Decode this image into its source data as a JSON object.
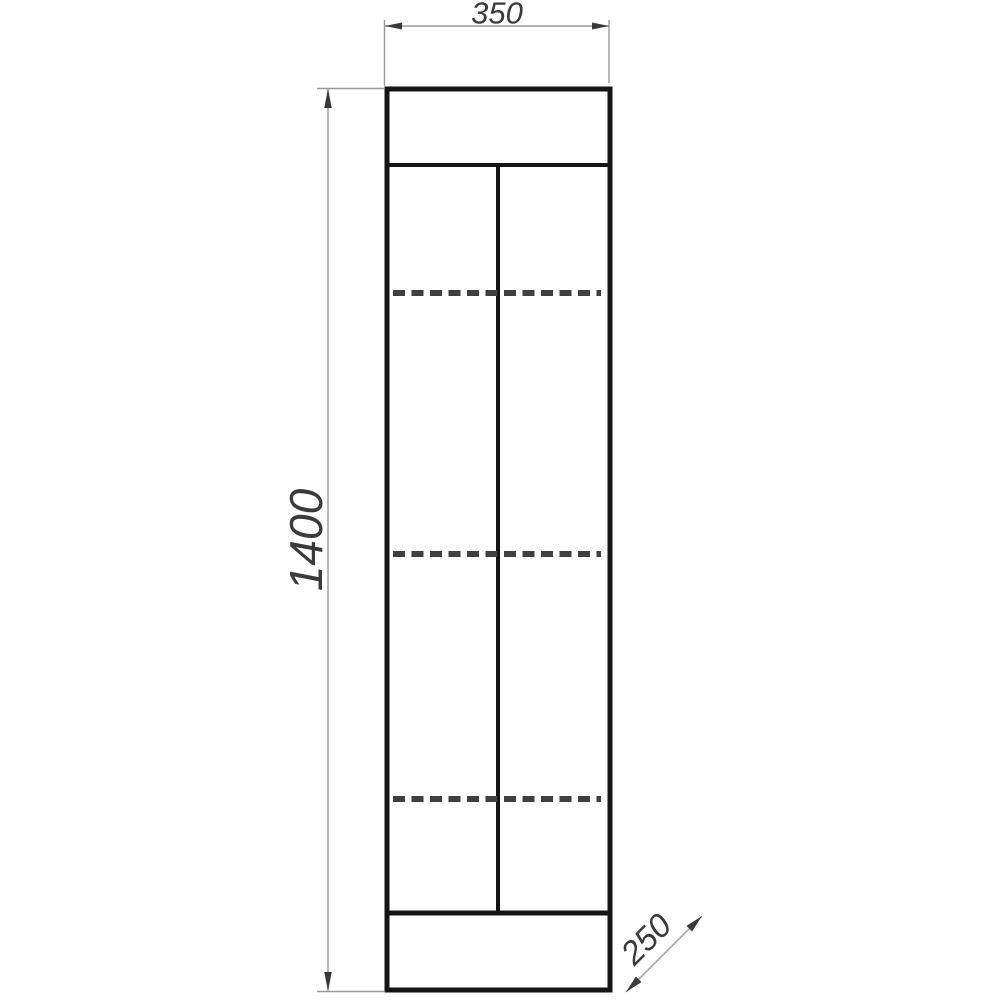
{
  "drawing": {
    "type": "cad-elevation",
    "subject": "tall two-door cabinet, front view with shelf lines",
    "background_color": "#ffffff",
    "outline_color": "#141414",
    "dashed_line_color": "#3f3f3f",
    "dimension_line_color": "#9b9b9b",
    "text_color": "#3a3a3a",
    "shelf_line_count": 3,
    "dimensions": {
      "width": {
        "value": "350",
        "orientation": "horizontal-top"
      },
      "height": {
        "value": "1400",
        "orientation": "vertical-left-rotated"
      },
      "depth": {
        "value": "250",
        "orientation": "diagonal-bottom-right"
      }
    }
  }
}
